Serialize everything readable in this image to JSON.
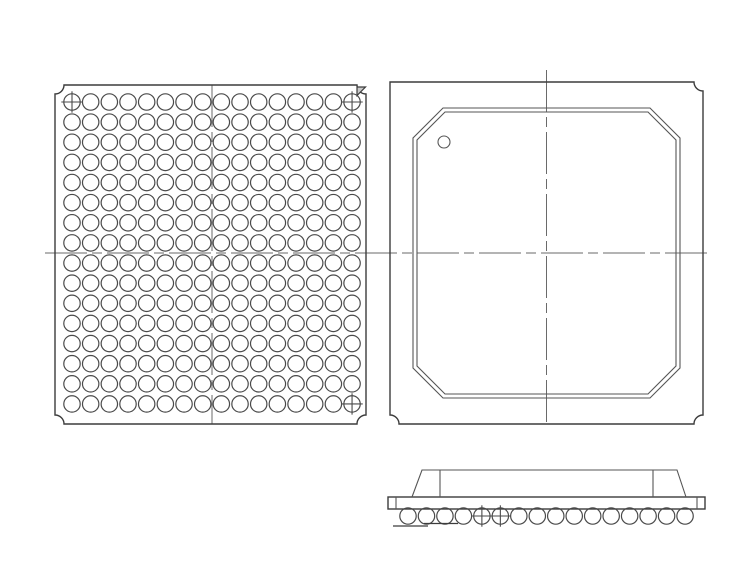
{
  "figure": {
    "kind": "bga-package-outline-drawing",
    "views": [
      "bottom-view-ball-grid",
      "top-view-mold-cap",
      "side-view-profile"
    ]
  },
  "colors": {
    "background": "#ffffff",
    "outline": "#3c3c3c",
    "thin_line": "#565656",
    "centerline": "#6a6a6a",
    "triangle_fill": "#c9c9c9"
  },
  "centerline_h": {
    "y": 253,
    "x1": 45,
    "x2": 712
  },
  "bottom_view": {
    "outline": {
      "x1": 55,
      "y1": 85,
      "x2": 366,
      "y2": 424,
      "notch_radius": 9,
      "notched_corners": [
        "tl",
        "tr",
        "br",
        "bl"
      ]
    },
    "ball_grid": {
      "rows": 16,
      "cols": 16,
      "x0": 72,
      "y0": 102,
      "pitch_x": 18.67,
      "pitch_y": 20.13,
      "ball_radius": 8.2,
      "total_balls": 256
    },
    "fiducial_balls": [
      {
        "row": 0,
        "col": 0
      },
      {
        "row": 0,
        "col": 15
      },
      {
        "row": 15,
        "col": 15
      }
    ],
    "pin1_triangle": {
      "points": [
        [
          357,
          87
        ],
        [
          365.5,
          87
        ],
        [
          357,
          95.5
        ]
      ]
    },
    "centerline_v": {
      "x": 212,
      "y1": 85,
      "y2": 424
    }
  },
  "top_view": {
    "outline": {
      "x1": 390,
      "y1": 82,
      "x2": 703,
      "y2": 424,
      "notch_radius": 9,
      "notched_corners": [
        "tr",
        "br",
        "bl"
      ]
    },
    "mold_cap_outer": [
      [
        443,
        108
      ],
      [
        650,
        108
      ],
      [
        680,
        138
      ],
      [
        680,
        368
      ],
      [
        650,
        398
      ],
      [
        443,
        398
      ],
      [
        413,
        368
      ],
      [
        413,
        138
      ]
    ],
    "mold_cap_inner": [
      [
        445,
        112
      ],
      [
        648,
        112
      ],
      [
        676,
        140
      ],
      [
        676,
        366
      ],
      [
        648,
        394
      ],
      [
        445,
        394
      ],
      [
        417,
        366
      ],
      [
        417,
        140
      ]
    ],
    "pin1_dot": {
      "cx": 444,
      "cy": 142,
      "r": 6
    },
    "centerline_v": {
      "x": 546.5,
      "y1": 70,
      "y2": 424
    }
  },
  "side_view": {
    "substrate": {
      "x1": 388,
      "y1": 497,
      "x2": 705,
      "y2": 509,
      "end_tab_offset": 8
    },
    "mold_cap": {
      "bottom_left": 412,
      "top_left": 422,
      "top_right": 677,
      "bottom_right": 686,
      "top_y": 470,
      "bottom_y": 497
    },
    "cap_inner_lines": [
      440,
      653
    ],
    "balls": {
      "count": 16,
      "x0": 408,
      "pitch": 18.47,
      "cy": 516,
      "r": 8.2
    },
    "fiducial_indices": [
      4,
      5
    ],
    "datum_lines": [
      [
        393,
        526,
        428,
        526
      ],
      [
        424,
        523.5,
        458,
        523.5
      ]
    ]
  }
}
